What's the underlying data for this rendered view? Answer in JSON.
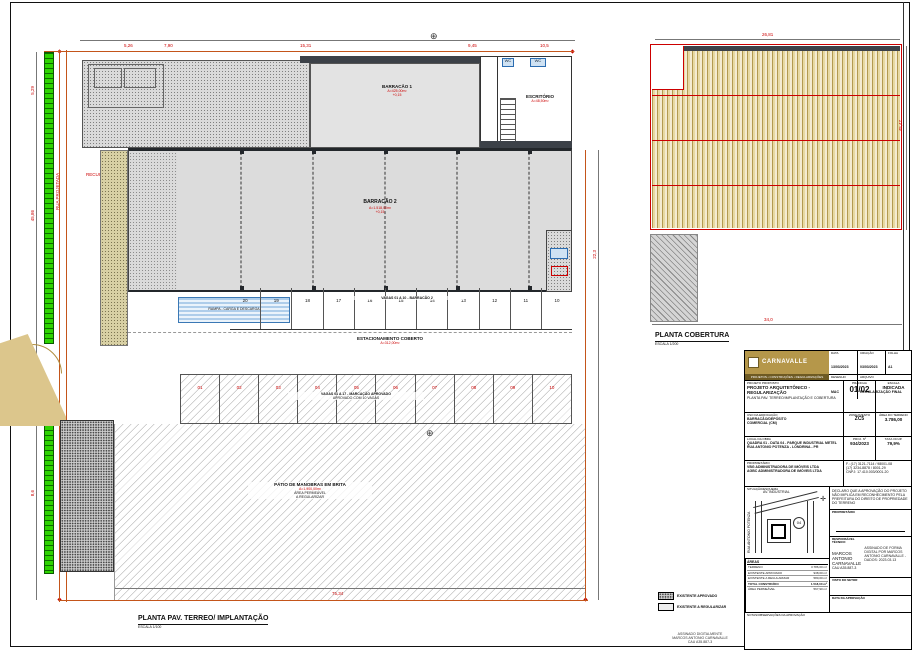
{
  "main_plan": {
    "title": "PLANTA PAV. TERREO/ IMPLANTAÇÃO",
    "scale": "ESCALA 1/100",
    "labels": {
      "recuo": "RECUO FRONTAL",
      "barracao1": "BARRACÃO 1",
      "barracao1_area": "A=425,00m²",
      "wc1": "WC",
      "wc2": "WC",
      "escritorio": "ESCRITÓRIO",
      "escritorio_area": "A=48,50m²",
      "barracao2": "BARRACÃO 2",
      "barracao2_area": "A=1.518,00m²",
      "nivel": "+0,15",
      "rampa": "RAMPA - CARGA E DESCARGA",
      "vagas_row1": "VAGAS 01 A 10 - BARRACÃO 2",
      "estacionamento": "ESTACIONAMENTO COBERTO",
      "estacionamento_area": "A=312,00m²",
      "vagas_row2_l1": "VAGAS 01 A 17 - MARCAÇÃO APROVADO",
      "vagas_row2_l2": "APROVADO COM 10 VAGAS",
      "patio_l1": "PÁTIO DE MANOBRAS EM BRITA",
      "patio_l2": "A=1.900,00m²",
      "patio_l3": "ÁREA PERMEÁVEL",
      "patio_l4": "A REGULARIZAR",
      "rua": "RUA PROJETADA"
    },
    "parking_row1": [
      "20",
      "19",
      "18",
      "17",
      "16",
      "15",
      "14",
      "13",
      "12",
      "11",
      "10"
    ],
    "parking_row2": [
      "01",
      "02",
      "03",
      "04",
      "05",
      "06",
      "07",
      "08",
      "09",
      "10"
    ],
    "dims": {
      "top1": "5,26",
      "top2": "7,90",
      "top3": "15,31",
      "top4": "9,45",
      "top5": "10,5",
      "left1": "5,29",
      "left2": "45,86",
      "left3": "8,6",
      "bottom1": "75,34",
      "right1": "22,3"
    }
  },
  "roof_plan": {
    "title": "PLANTA COBERTURA",
    "scale": "ESCALA 1/200",
    "dims": {
      "top": "26,81",
      "right": "45,47",
      "bottom": "34,0"
    }
  },
  "legend": {
    "item1": "EXISTENTE APROVADO",
    "item2": "EXISTENTE A REGULARIZAR"
  },
  "titleblock": {
    "logo": "CARNAVALLE",
    "logo_sub": "PROJETOS • CONSTRUÇÕES • REGULARIZAÇÕES",
    "meta": {
      "data_label": "DATA",
      "data": "13/03/2023",
      "criacao_label": "CRIAÇÃO",
      "criacao": "03/03/2023",
      "folha_label": "FOLHA",
      "folha": "A1",
      "desenho_label": "DESENHO",
      "desenho": "MAC",
      "arquivo_label": "ARQUIVO",
      "arquivo": "REGULARIZAÇÃO FINAL"
    },
    "projeto_label": "PROJETO PROPOSTO",
    "projeto": "PROJETO ARQUITETÔNICO - REGULARIZAÇÃO",
    "projeto_sub": "PLANTA PAV. TERREO/IMPLANTAÇÃO E COBERTURA",
    "prancha_label": "PRANCHA",
    "prancha": "01/02",
    "escala_label": "ESCALA",
    "escala": "INDICADA",
    "uso_label": "USO DA EDIFICAÇÃO",
    "uso1": "BARRACÃO/DEPÓSITO",
    "uso2": "COMERCIAL (CM)",
    "zona_label": "ZONEAMENTO",
    "zona": "ZC5",
    "terreno_label": "ÁREA DO TERRENO",
    "terreno": "3.786,00",
    "local_label": "LOCAL DA OBRA",
    "local1": "QUADRA 01 - DATA 04 - PARQUE INDUSTRIAL METEL",
    "local2": "RUA ANTONIO POTENZA - LONDRINA - PR",
    "proj_label": "PROJ. Nº",
    "proj": "934/2023",
    "ocup_label": "TAXA OCUP.",
    "ocup": "79,9%",
    "prop_label": "PROPRIETÁRIO",
    "prop1": "VBG ADMINISTRADORA DE IMÓVEIS LTDA",
    "prop2": "AGBC ADMINISTRADORA DE IMÓVEIS LTDA",
    "fone1": "F.: (17) 3121-7114 / 98001-08",
    "fone2": "(17) 3234-8878 / 8001-29",
    "cnpj": "CNPJ: 17.410.003/0001-20",
    "situacao_label": "SITUAÇÃO/ESQUEMA",
    "decl": "DECLARO QUE A APROVAÇÃO DO PROJETO NÃO IMPLICA EM RECONHECIMENTO PELA PREFEITURA DO DIREITO DE PROPRIEDADE DO TERRENO",
    "sig1_label": "PROPRIETÁRIO",
    "sig2_label": "RESPONSÁVEL TÉCNICO",
    "rt_nome": "MARCOS ANTONIO",
    "rt_nome2": "CARNAVALLE",
    "rt_cau": "CAU A35.887-3",
    "stamp": "ASSINADO DE FORMA DIGITAL POR MARCOS ANTONIO CARNAVALLE - DADOS: 2023.03.13",
    "visto_label": "VISTO DO SETOR",
    "aprov_label": "DATA DA APROVAÇÃO",
    "areas_label": "ÁREAS",
    "areas": [
      {
        "label": "TERRENO",
        "value": "3.786,00 m²"
      },
      {
        "label": "EXISTENTE APROVADO",
        "value": "938,00 m²"
      },
      {
        "label": "EXISTENTE A REGULARIZAR",
        "value": "580,00 m²"
      },
      {
        "label": "TOTAL CONSTRUÍDO",
        "value": "1.518,00 m²"
      },
      {
        "label": "ÁREA PERMEÁVEL",
        "value": "567,90 m²"
      }
    ],
    "notas_label": "NOTAS/OBSERVAÇÕES DA APROVAÇÃO"
  },
  "sketch": {
    "lot": "04",
    "street1": "RUA ANTONIO POTENZA",
    "street2": "AV. INDUSTRIAL"
  },
  "footer": {
    "l1": "ASSINADO DIGITALMENTE",
    "l2": "MARCOS ANTONIO CARNAVALLE",
    "l3": "CAU A35.887-3"
  }
}
